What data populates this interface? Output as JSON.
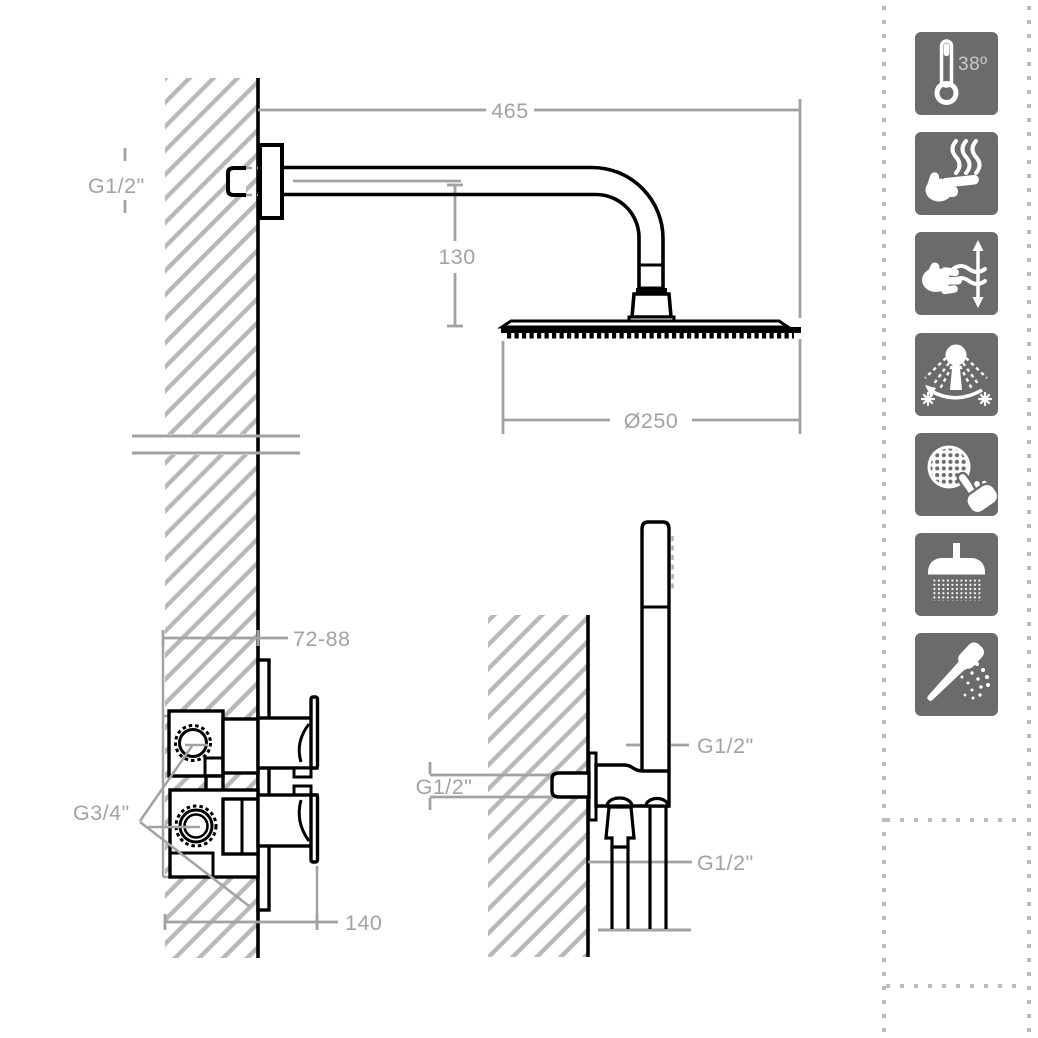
{
  "drawing": {
    "overhead_shower": {
      "arm_length": "465",
      "drop_height": "130",
      "wall_connection_thread": "G1/2\"",
      "head_diameter": "Ø250"
    },
    "concealed_valve": {
      "recess_depth_range": "72-88",
      "inlet_thread": "G3/4\"",
      "overall_depth": "140"
    },
    "hand_shower": {
      "handle_connection_thread": "G1/2\"",
      "wall_outlet_thread": "G1/2\"",
      "hose_thread": "G1/2\""
    }
  },
  "features": {
    "temperature_label": "38º",
    "icons": [
      {
        "name": "thermostatic-38-degrees-icon"
      },
      {
        "name": "anti-scald-safe-touch-icon"
      },
      {
        "name": "flow-volume-control-icon"
      },
      {
        "name": "hot-cold-swivel-spray-icon"
      },
      {
        "name": "touch-clean-spray-plate-icon"
      },
      {
        "name": "overhead-rain-spray-icon"
      },
      {
        "name": "handheld-shower-spray-icon"
      }
    ]
  },
  "colors": {
    "line": "#000000",
    "dimension": "#a2a2a2",
    "hatch": "#b8b8b8",
    "tile_background": "#6b6b6b",
    "glyph": "#ffffff",
    "dotted_border": "#bcbcbc"
  }
}
